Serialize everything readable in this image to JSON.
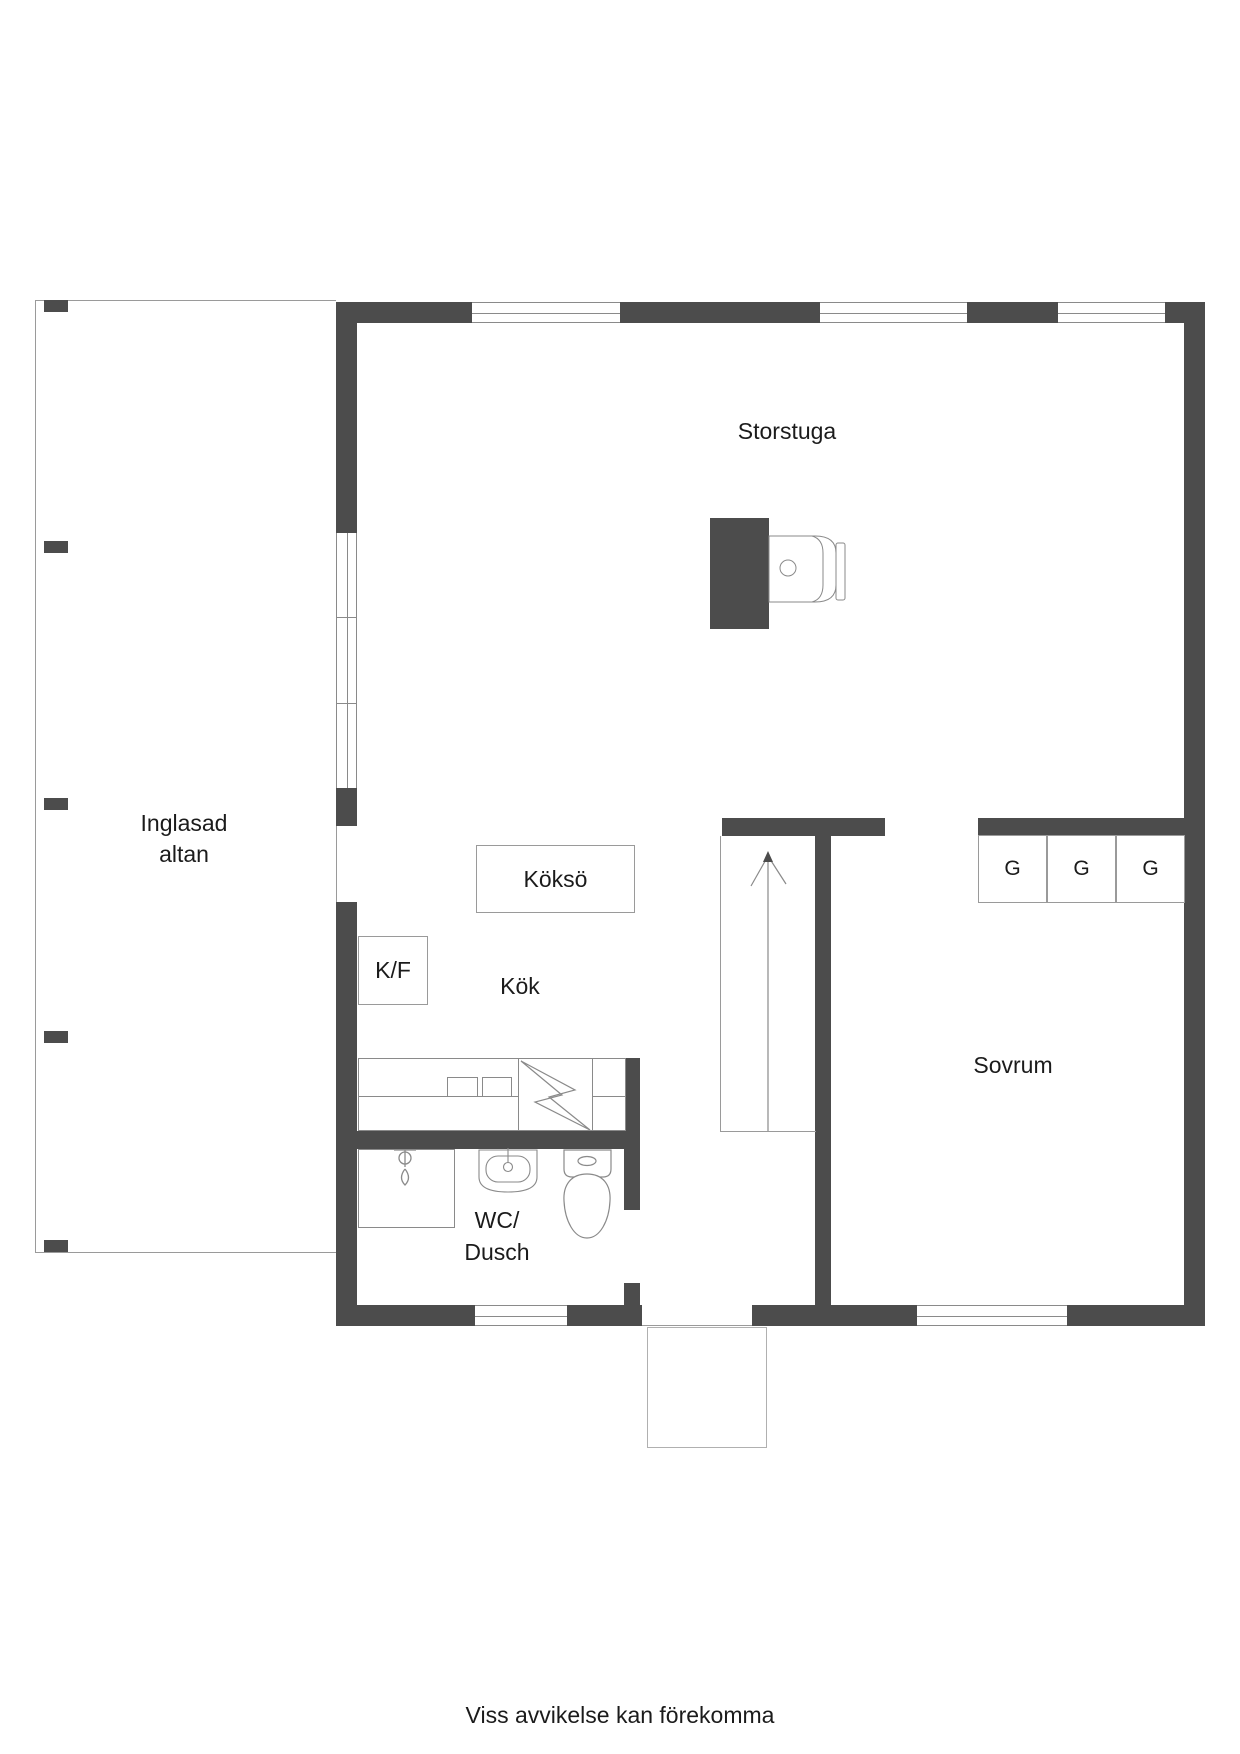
{
  "floorplan": {
    "labels": {
      "storstuga": "Storstuga",
      "inglasad_line1": "Inglasad",
      "inglasad_line2": "altan",
      "kokso": "Köksö",
      "kf": "K/F",
      "kok": "Kök",
      "wc_line1": "WC/",
      "wc_line2": "Dusch",
      "sovrum": "Sovrum",
      "closet1": "G",
      "closet2": "G",
      "closet3": "G"
    },
    "footer": "Viss avvikelse kan förekomma",
    "icons": [
      "fireplace-icon",
      "stove-icon",
      "lightning-icon",
      "shower-tap-icon",
      "sink-icon",
      "toilet-icon",
      "stairs-arrow-icon"
    ],
    "colors": {
      "wall": "#4c4c4c",
      "thin_line": "#9a9a9a",
      "fixture_line": "#8a8a8a",
      "text": "#1b1b1b"
    }
  }
}
